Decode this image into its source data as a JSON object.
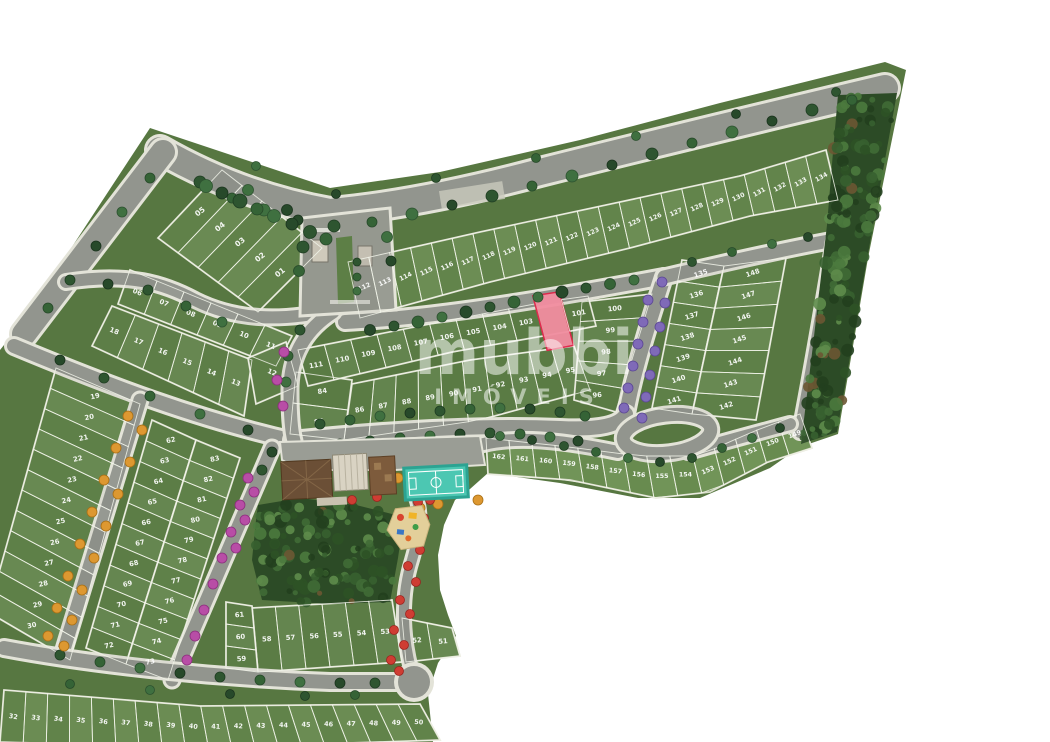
{
  "map": {
    "watermark": {
      "brand": "mubbi",
      "subtitle": "IMÓVEIS"
    },
    "highlighted_lot": {
      "number": "102",
      "fill": "#f28da0",
      "stroke": "#e02348"
    },
    "colors": {
      "background": "#ffffff",
      "land": "#577741",
      "road": "#92958e",
      "sidewalk": "#e3e3d8",
      "forest": "#2c4b26",
      "court": "#4cc7b2",
      "tree_green": "#2e5530",
      "tree_orange": "#dd9831",
      "tree_magenta": "#b84da6",
      "tree_purple": "#7f6ab8",
      "tree_red": "#cf3d33"
    },
    "blocks": [
      {
        "id": "block-01-05",
        "lots": [
          "05",
          "04",
          "03",
          "02",
          "01"
        ]
      },
      {
        "id": "row-06-11",
        "lots": [
          "06",
          "07",
          "08",
          "09",
          "10",
          "11"
        ]
      },
      {
        "id": "row-13-18",
        "lots": [
          "18",
          "17",
          "16",
          "15",
          "14",
          "13"
        ]
      },
      {
        "id": "lot-12",
        "lots": [
          "12"
        ]
      },
      {
        "id": "col-19-30",
        "lots": [
          "19",
          "20",
          "21",
          "22",
          "23",
          "24",
          "25",
          "26",
          "27",
          "28",
          "29",
          "30"
        ]
      },
      {
        "id": "row-32-50",
        "lots": [
          "32",
          "33",
          "34",
          "35",
          "36",
          "37",
          "38",
          "39",
          "40",
          "41",
          "42",
          "43",
          "44",
          "45",
          "46",
          "47",
          "48",
          "49",
          "50"
        ]
      },
      {
        "id": "wedge-51-52",
        "lots": [
          "52",
          "51"
        ]
      },
      {
        "id": "row-53-58",
        "lots": [
          "58",
          "57",
          "56",
          "55",
          "54",
          "53"
        ]
      },
      {
        "id": "col-59-61",
        "lots": [
          "61",
          "60",
          "59"
        ]
      },
      {
        "id": "col-62-72",
        "lots": [
          "62",
          "63",
          "64",
          "65",
          "66",
          "67",
          "68",
          "69",
          "70",
          "71",
          "72"
        ]
      },
      {
        "id": "col-73-83",
        "lots": [
          "83",
          "82",
          "81",
          "80",
          "79",
          "78",
          "77",
          "76",
          "75",
          "74",
          "73"
        ]
      },
      {
        "id": "stack-84-85",
        "lots": [
          "84",
          "85"
        ]
      },
      {
        "id": "row-86-95",
        "lots": [
          "86",
          "87",
          "88",
          "89",
          "90",
          "91",
          "92",
          "93",
          "94",
          "95"
        ]
      },
      {
        "id": "col-96-100",
        "lots": [
          "100",
          "99",
          "98",
          "97",
          "96"
        ]
      },
      {
        "id": "row-101-111",
        "lots": [
          "111",
          "110",
          "109",
          "108",
          "107",
          "106",
          "105",
          "104",
          "103",
          "102",
          "101"
        ]
      },
      {
        "id": "band-112-134",
        "lots": [
          "112",
          "113",
          "114",
          "115",
          "116",
          "117",
          "118",
          "119",
          "120",
          "121",
          "122",
          "123",
          "124",
          "125",
          "126",
          "127",
          "128",
          "129",
          "130",
          "131",
          "132",
          "133",
          "134"
        ]
      },
      {
        "id": "col-135-141",
        "lots": [
          "135",
          "136",
          "137",
          "138",
          "139",
          "140",
          "141"
        ]
      },
      {
        "id": "col-142-148",
        "lots": [
          "148",
          "147",
          "146",
          "145",
          "144",
          "143",
          "142"
        ]
      },
      {
        "id": "band-149-162",
        "lots": [
          "162",
          "161",
          "160",
          "159",
          "158",
          "157",
          "156",
          "155",
          "154",
          "153",
          "152",
          "151",
          "150",
          "149"
        ]
      }
    ],
    "amenities": [
      "entrance-gate",
      "clubhouse",
      "sport-court",
      "playground",
      "cul-de-sac"
    ]
  }
}
